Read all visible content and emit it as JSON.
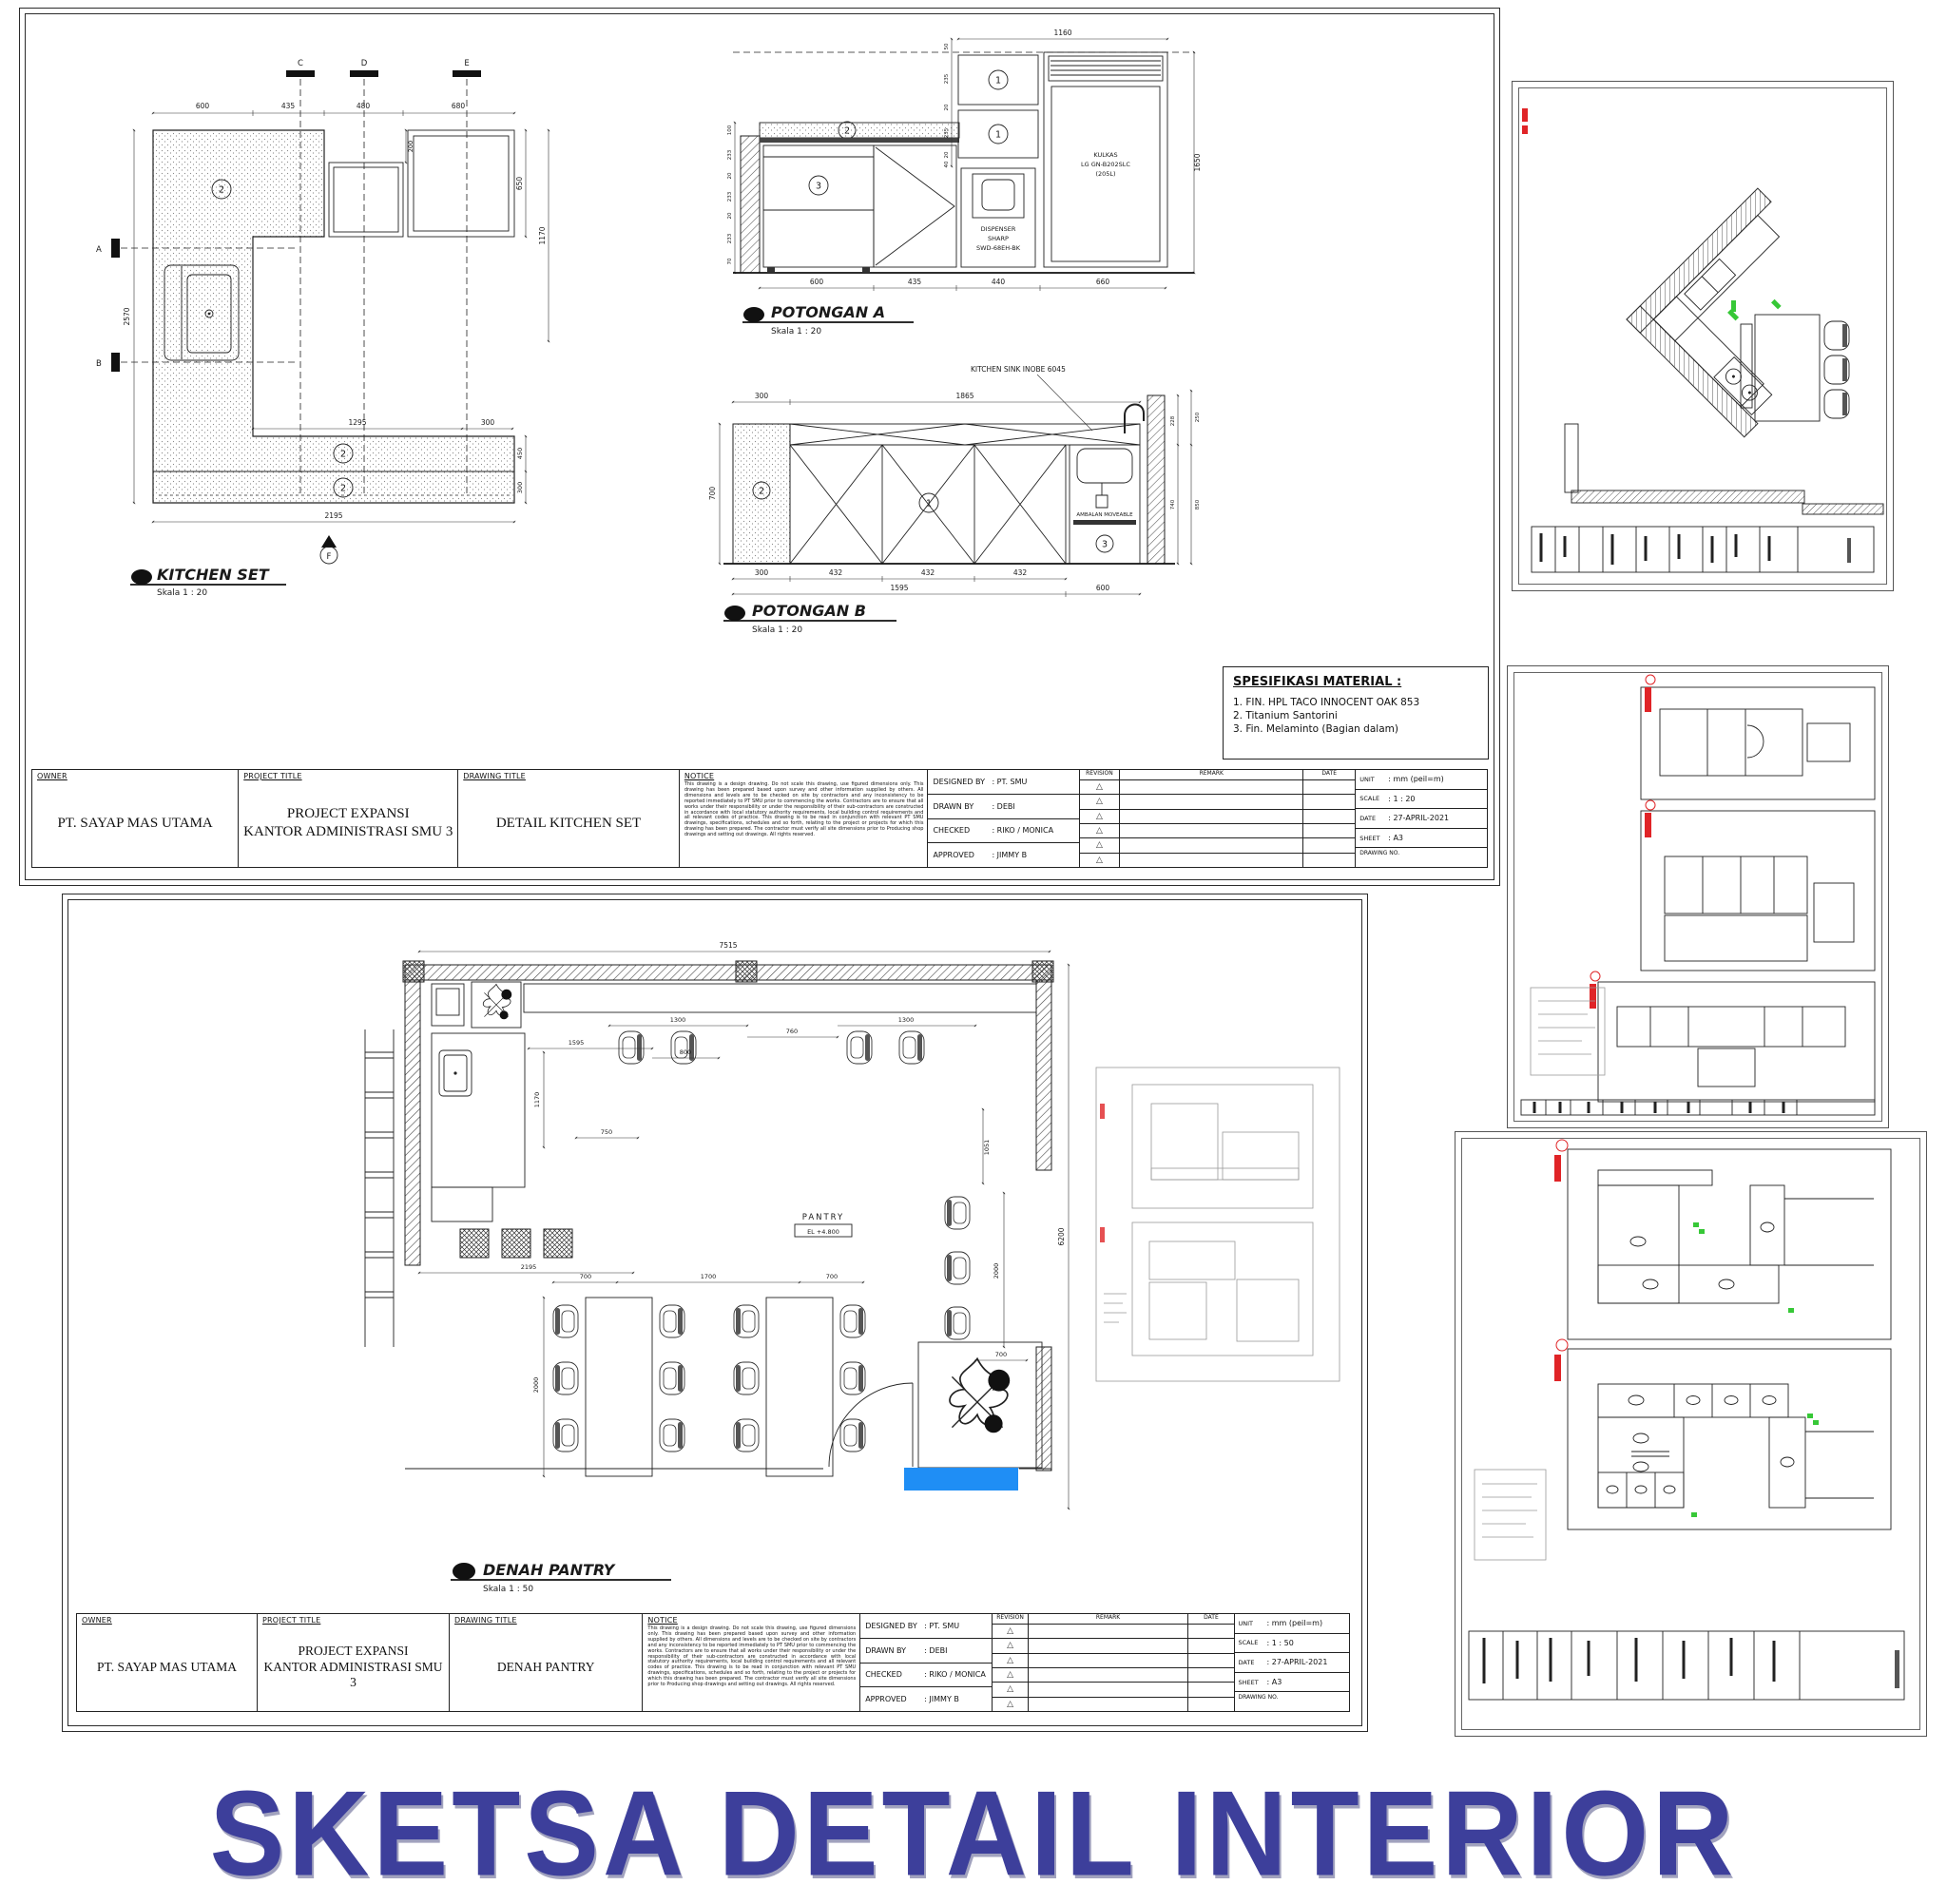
{
  "colors": {
    "title_navy": "#3d3f9b",
    "accent_blue": "#1f8ef5",
    "marker_red": "#e02427",
    "marker_green": "#37c837"
  },
  "page": {
    "title": "SKETSA DETAIL INTERIOR",
    "title_style": "color:#3d3f9b"
  },
  "titleblock": {
    "h_owner": "OWNER",
    "h_project": "PROJECT TITLE",
    "h_drawing": "DRAWING TITLE",
    "h_notice": "NOTICE",
    "h_revision": "REVISION",
    "h_remark": "REMARK",
    "h_date": "DATE",
    "owner": "PT. SAYAP MAS UTAMA",
    "project1": "PROJECT EXPANSI",
    "project2": "KANTOR ADMINISTRASI SMU 3",
    "notice": "This drawing is a design drawing. Do not scale this drawing, use figured dimensions only. This drawing has been prepared based upon survey and other information supplied by others. All dimensions and levels are to be checked on site by contractors and any inconsistency to be reported immediately to PT SMU prior to commencing the works. Contractors are to ensure that all works under their responsibility or under the responsibility of their sub-contractors are constructed in accordance with local statutory authority requirements, local building control requirements and all relevant codes of practice. This drawing is to be read in conjunction with relevant PT SMU drawings, specifications, schedules and so forth, relating to the project or projects for which this drawing has been prepared. The contractor must verify all site dimensions prior to Producing shop drawings and setting out drawings. All rights reserved.",
    "rev_mark": "△",
    "r1l": "DESIGNED BY",
    "r1v": ": PT. SMU",
    "r2l": "DRAWN BY",
    "r2v": ": DEBI",
    "r3l": "CHECKED",
    "r3v": ": RIKO / MONICA",
    "r4l": "APPROVED",
    "r4v": ": JIMMY B",
    "m_unit_l": "UNIT",
    "m_unit_v": ": mm (peil=m)",
    "m_scale_l": "SCALE",
    "m_date_l": "DATE",
    "m_date_v": ": 27-APRIL-2021",
    "m_sheet_l": "SHEET",
    "m_sheet_v": ": A3",
    "m_dwg": "DRAWING NO.",
    "s1_drawing": "DETAIL KITCHEN SET",
    "s1_scale": ": 1 : 20",
    "s2_drawing": "DENAH PANTRY",
    "s2_scale": ": 1 : 50"
  },
  "sheet1": {
    "plan": {
      "label": "KITCHEN SET",
      "scale": "Skala 1 : 20",
      "sec_c": "C",
      "sec_d": "D",
      "sec_e": "E",
      "sec_a": "A",
      "sec_b": "B",
      "sec_f": "F",
      "d600": "600",
      "d435": "435",
      "d480": "480",
      "d680": "680",
      "d200": "200",
      "d650": "650",
      "d1170": "1170",
      "d2570": "2570",
      "d1295": "1295",
      "d300": "300",
      "d450": "450",
      "d2195": "2195",
      "tag2": "2"
    },
    "pa": {
      "label": "POTONGAN A",
      "scale": "Skala 1 : 20",
      "d1160": "1160",
      "d1650": "1650",
      "left_upper": [
        "50",
        "235",
        "20",
        "235",
        "20",
        "40"
      ],
      "left_lower": [
        "100",
        "233",
        "20",
        "233",
        "20",
        "233",
        "70"
      ],
      "bottom": [
        "600",
        "435",
        "440",
        "660"
      ],
      "tag1": "1",
      "tag2": "2",
      "tag3": "3",
      "dispenser": [
        "DISPENSER",
        "SHARP",
        "SWD-68EH-BK"
      ],
      "kulkas": [
        "KULKAS",
        "LG GN-B202SLC",
        "(205L)"
      ]
    },
    "pb": {
      "label": "POTONGAN B",
      "scale": "Skala 1 : 20",
      "sink_note": "KITCHEN SINK INOBE 6045",
      "ambalan": "AMBALAN MOVEABLE",
      "d300": "300",
      "d1865": "1865",
      "d700": "700",
      "right": [
        "228",
        "250",
        "740",
        "850"
      ],
      "d432": "432",
      "d1595": "1595",
      "d600": "600",
      "tag1": "1",
      "tag2": "2",
      "tag3": "3"
    },
    "spek": {
      "title": "SPESIFIKASI MATERIAL :",
      "items": [
        "1. FIN. HPL TACO INNOCENT OAK 853",
        "2. Titanium Santorini",
        "3. Fin. Melaminto (Bagian dalam)"
      ]
    }
  },
  "sheet2": {
    "plan": {
      "label": "DENAH PANTRY",
      "scale": "Skala 1 : 50",
      "room": "PANTRY",
      "el": "EL +4.800",
      "d7515": "7515",
      "d1595": "1595",
      "d800": "800",
      "d1300": "1300",
      "d760": "760",
      "d1170": "1170",
      "d750": "750",
      "d2195": "2195",
      "d700": "700",
      "d1700": "1700",
      "d2000": "2000",
      "d1051": "1051",
      "d6200": "6200"
    }
  }
}
